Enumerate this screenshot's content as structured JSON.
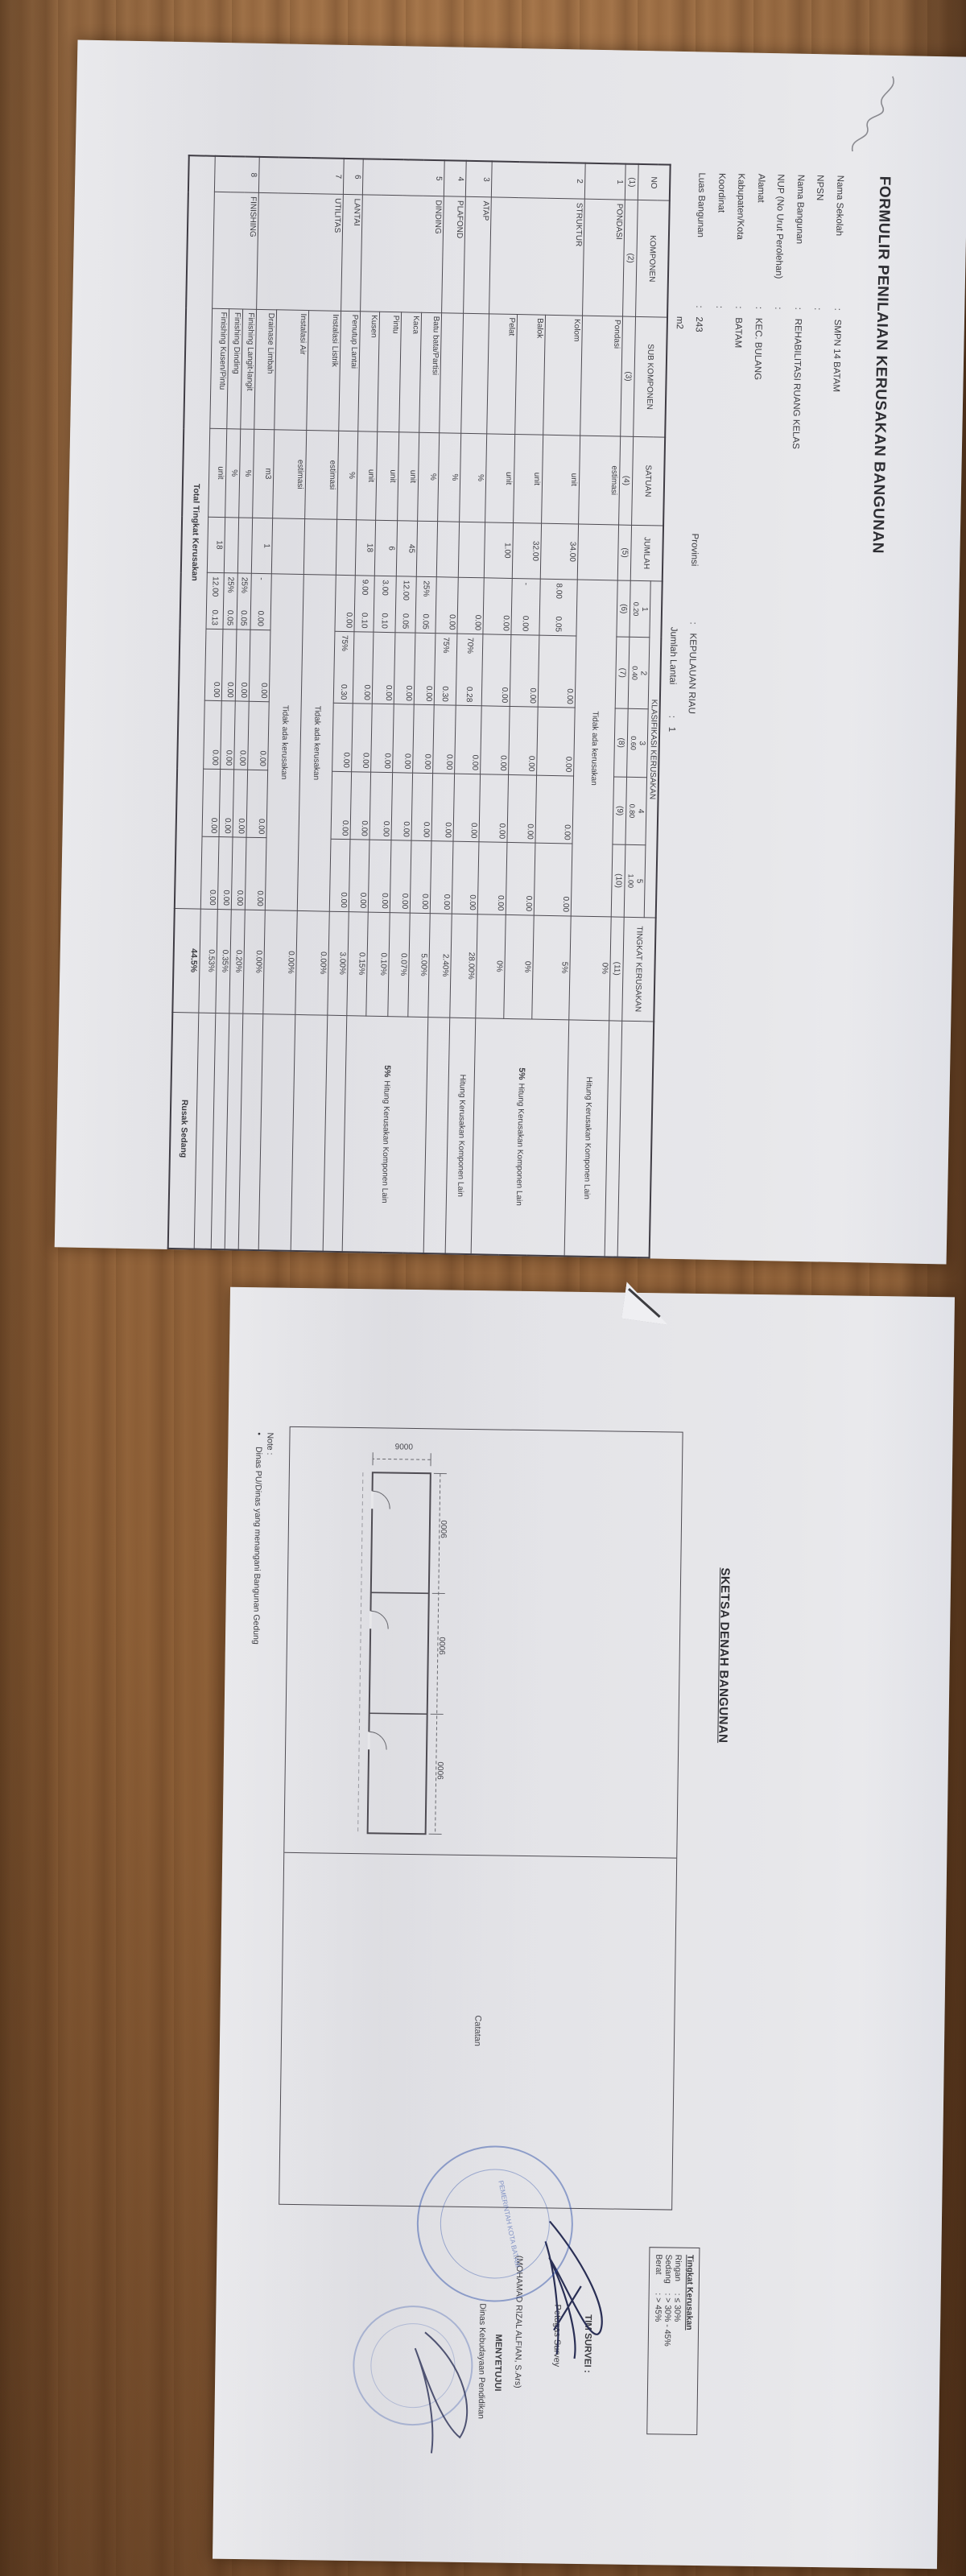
{
  "page1": {
    "title": "FORMULIR PENILAIAN KERUSAKAN BANGUNAN",
    "fields": [
      {
        "label": "Nama Sekolah",
        "value": "SMPN 14 BATAM",
        "right_label": "",
        "right_value": ""
      },
      {
        "label": "NPSN",
        "value": "",
        "right_label": "",
        "right_value": ""
      },
      {
        "label": "Nama Bangunan",
        "value": "REHABILITASI RUANG KELAS",
        "right_label": "",
        "right_value": ""
      },
      {
        "label": "NUP (No Urut Perolehan)",
        "value": "",
        "right_label": "",
        "right_value": ""
      },
      {
        "label": "Alamat",
        "value": "KEC. BULANG",
        "right_label": "",
        "right_value": ""
      },
      {
        "label": "Kabupaten/Kota",
        "value": "BATAM",
        "right_label": "",
        "right_value": ""
      },
      {
        "label": "Koordinat",
        "value": "",
        "right_label": "",
        "right_value": ""
      },
      {
        "label": "Luas Bangunan",
        "value": "243",
        "right_label": "Provinsi",
        "right_value": "KEPULAUAN RIAU"
      },
      {
        "label": "",
        "value": "m2",
        "right_label": "Jumlah Lantai",
        "right_value": "1"
      }
    ],
    "table": {
      "headers": {
        "no": "NO",
        "komponen": "KOMPONEN",
        "sub": "SUB KOMPONEN",
        "satuan": "SATUAN",
        "jumlah": "JUMLAH",
        "klasifikasi": "KLASIFIKASI KERUSAKAN",
        "tingkat": "TINGKAT KERUSAKAN"
      },
      "klas": [
        {
          "no": "1",
          "bobot": "0.20"
        },
        {
          "no": "2",
          "bobot": "0.40"
        },
        {
          "no": "3",
          "bobot": "0.60"
        },
        {
          "no": "4",
          "bobot": "0.80"
        },
        {
          "no": "5",
          "bobot": "1.00"
        }
      ],
      "col_numbers": [
        "(1)",
        "(2)",
        "(3)",
        "(4)",
        "(5)",
        "(6)",
        "(7)",
        "(8)",
        "(9)",
        "(10)",
        "(11)",
        ""
      ],
      "no_damage_text": "Tidak ada kerusakan",
      "note_text": "Hitung Kerusakan Komponen Lain",
      "rows": [
        {
          "no": "1",
          "komp": "PONDASI",
          "kompRows": 1,
          "sub": "Pondasi",
          "satuan": "estimasi",
          "jumlah": "",
          "span": true,
          "tingkat": "0%",
          "noteBold": "",
          "noteText": "Hitung Kerusakan Komponen Lain",
          "noteRows": 1,
          "h": 50
        },
        {
          "no": "2",
          "komp": "STRUKTUR",
          "kompRows": 3,
          "sub": "Kolom",
          "satuan": "unit",
          "jumlah": "34.00",
          "cells": [
            [
              "8.00",
              "0.05"
            ],
            [
              "0.00"
            ],
            [
              "0.00"
            ],
            [
              "0.00"
            ],
            [
              "0.00"
            ]
          ],
          "tingkat": "5%",
          "noteBold": "5%",
          "noteText": "Hitung Kerusakan Komponen Lain",
          "noteRows": 3,
          "h": 46
        },
        {
          "sub": "Balok",
          "satuan": "unit",
          "jumlah": "32.00",
          "cells": [
            [
              "-",
              "0.00"
            ],
            [
              "0.00"
            ],
            [
              "0.00"
            ],
            [
              "0.00"
            ],
            [
              "0.00"
            ]
          ],
          "tingkat": "0%",
          "h": 35
        },
        {
          "sub": "Pelat",
          "satuan": "unit",
          "jumlah": "1.00",
          "cells": [
            [
              "",
              "0.00"
            ],
            [
              "0.00"
            ],
            [
              "0.00"
            ],
            [
              "0.00"
            ],
            [
              "0.00"
            ]
          ],
          "tingkat": "0%",
          "h": 35
        },
        {
          "no": "3",
          "komp": "ATAP",
          "kompRows": 1,
          "sub": "",
          "satuan": "%",
          "jumlah": "",
          "cells": [
            [
              "",
              "0.00"
            ],
            [
              "70%",
              "0.28"
            ],
            [
              "0.00"
            ],
            [
              "0.00"
            ],
            [
              "0.00"
            ]
          ],
          "tingkat": "28.00%",
          "noteBold": "",
          "noteText": "Hitung Kerusakan Komponen Lain",
          "noteRows": 1,
          "h": 32
        },
        {
          "no": "4",
          "komp": "PLAFOND",
          "kompRows": 1,
          "sub": "",
          "satuan": "%",
          "jumlah": "",
          "cells": [
            [
              "",
              "0.00"
            ],
            [
              "75%",
              "0.30"
            ],
            [
              "0.00"
            ],
            [
              "0.00"
            ],
            [
              "0.00"
            ]
          ],
          "tingkat": "2.40%",
          "h": 27
        },
        {
          "no": "5",
          "komp": "DINDING",
          "kompRows": 4,
          "sub": "Batu bata/Partisi",
          "satuan": "%",
          "jumlah": "",
          "cells": [
            [
              "25%",
              "0.05"
            ],
            [
              "0.00"
            ],
            [
              "0.00"
            ],
            [
              "0.00"
            ],
            [
              "0.00"
            ]
          ],
          "tingkat": "5.00%",
          "noteBold": "5%",
          "noteText": "Hitung Kerusakan Komponen Lain",
          "noteRows": 4,
          "h": 25
        },
        {
          "sub": "Kaca",
          "satuan": "unit",
          "jumlah": "45",
          "cells": [
            [
              "12.00",
              "0.05"
            ],
            [
              "0.00"
            ],
            [
              "0.00"
            ],
            [
              "0.00"
            ],
            [
              "0.00"
            ]
          ],
          "tingkat": "0.07%",
          "h": 25
        },
        {
          "sub": "Pintu",
          "satuan": "unit",
          "jumlah": "6",
          "cells": [
            [
              "3.00",
              "0.10"
            ],
            [
              "0.00"
            ],
            [
              "0.00"
            ],
            [
              "0.00"
            ],
            [
              "0.00"
            ]
          ],
          "tingkat": "0.10%",
          "h": 27
        },
        {
          "sub": "Kusen",
          "satuan": "unit",
          "jumlah": "18",
          "cells": [
            [
              "9.00",
              "0.10"
            ],
            [
              "0.00"
            ],
            [
              "0.00"
            ],
            [
              "0.00"
            ],
            [
              "0.00"
            ]
          ],
          "tingkat": "0.15%",
          "h": 24
        },
        {
          "no": "6",
          "komp": "LANTAI",
          "kompRows": 1,
          "sub": "Penutup Lantai",
          "satuan": "%",
          "jumlah": "",
          "cells": [
            [
              "",
              "0.00"
            ],
            [
              "75%",
              "0.30"
            ],
            [
              "0.00"
            ],
            [
              "0.00"
            ],
            [
              "0.00"
            ]
          ],
          "tingkat": "3.00%",
          "h": 24
        },
        {
          "no": "7",
          "komp": "UTILITAS",
          "kompRows": 3,
          "sub": "Instalasi Listrik",
          "satuan": "estimasi",
          "jumlah": "",
          "span": true,
          "tingkat": "0.00%",
          "h": 40
        },
        {
          "sub": "Instalasi Air",
          "satuan": "estimasi",
          "jumlah": "",
          "span": true,
          "tingkat": "0.00%",
          "h": 40
        },
        {
          "sub": "Drainase Limbah",
          "satuan": "m3",
          "jumlah": "1",
          "cells": [
            [
              "-",
              "0.00"
            ],
            [
              "0.00"
            ],
            [
              "0.00"
            ],
            [
              "0.00"
            ],
            [
              "0.00"
            ]
          ],
          "tingkat": "0.00%",
          "h": 25
        },
        {
          "no": "8",
          "komp": "FINISHING",
          "kompRows": 3,
          "sub": "Finishing Langit-langit",
          "satuan": "%",
          "jumlah": "",
          "cells": [
            [
              "25%",
              "0.05"
            ],
            [
              "0.00"
            ],
            [
              "0.00"
            ],
            [
              "0.00"
            ],
            [
              "0.00"
            ]
          ],
          "tingkat": "0.20%",
          "h": 17
        },
        {
          "sub": "Finishing Dinding",
          "satuan": "%",
          "jumlah": "",
          "cells": [
            [
              "25%",
              "0.05"
            ],
            [
              "0.00"
            ],
            [
              "0.00"
            ],
            [
              "0.00"
            ],
            [
              "0.00"
            ]
          ],
          "tingkat": "0.35%",
          "h": 17
        },
        {
          "sub": "Finishing Kusen/Pintu",
          "satuan": "unit",
          "jumlah": "18",
          "cells": [
            [
              "12.00",
              "0.13"
            ],
            [
              "0.00"
            ],
            [
              "0.00"
            ],
            [
              "0.00"
            ],
            [
              "0.00"
            ]
          ],
          "tingkat": "0.53%",
          "h": 21
        }
      ],
      "total": {
        "label": "Total Tingkat Kerusakan",
        "value": "44.5%",
        "status": "Rusak Sedang"
      }
    }
  },
  "page2": {
    "title": "SKETSA DENAH BANGUNAN",
    "catatan_label": "Catatan",
    "dims": {
      "width_labels": [
        "9000",
        "9000",
        "9000"
      ],
      "height_label": "9000"
    },
    "legend": {
      "title": "Tingkat Kerusakan",
      "rows": [
        {
          "label": "Ringan",
          "value": ": ≤ 30%"
        },
        {
          "label": "Sedang",
          "value": ": > 30% - 45%"
        },
        {
          "label": "Berat",
          "value": ": > 45%"
        }
      ]
    },
    "survey": {
      "team_label": "TIM SURVEI :",
      "officer_label": "Petugas Survey",
      "officer_name": "(MOHAMAD RIZAL ALFIAN, S.Ars)",
      "approve_label": "MENYETUJUI",
      "approve_org": "Dinas Kebudayaan Pendidikan",
      "stamp_text": "PEMERINTAH KOTA BATAM"
    },
    "note": {
      "label": "Note :",
      "bullet": "•",
      "text": "Dinas PU/Dinas yang menangani Bangunan Gedung"
    }
  }
}
